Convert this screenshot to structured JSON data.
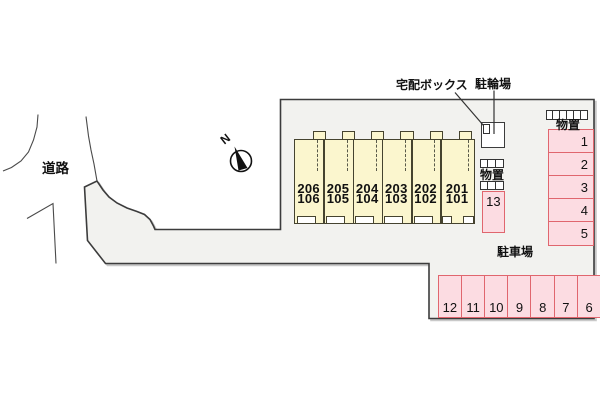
{
  "labels": {
    "road": "道路",
    "delivery_box": "宅配ボックス",
    "bicycle_parking": "駐輪場",
    "storage_top": "物置",
    "storage_mid": "物置",
    "parking_lot": "駐車場",
    "north": "N"
  },
  "building": {
    "units": [
      {
        "upper": "206",
        "lower": "106"
      },
      {
        "upper": "205",
        "lower": "105"
      },
      {
        "upper": "204",
        "lower": "104"
      },
      {
        "upper": "203",
        "lower": "103"
      },
      {
        "upper": "202",
        "lower": "102"
      },
      {
        "upper": "201",
        "lower": "101"
      }
    ]
  },
  "parking": {
    "right_column_spaces": [
      "1",
      "2",
      "3",
      "4",
      "5"
    ],
    "single_space": "13",
    "bottom_row_spaces": [
      "12",
      "11",
      "10",
      "9",
      "8",
      "7",
      "6"
    ]
  },
  "colors": {
    "site_fill": "#F2F2EF",
    "site_outline": "#3C3C3C",
    "building_fill": "#FBF6CE",
    "building_outline": "#45432F",
    "parking_space_fill": "#FCDCE2",
    "parking_space_border": "#E0666E"
  }
}
